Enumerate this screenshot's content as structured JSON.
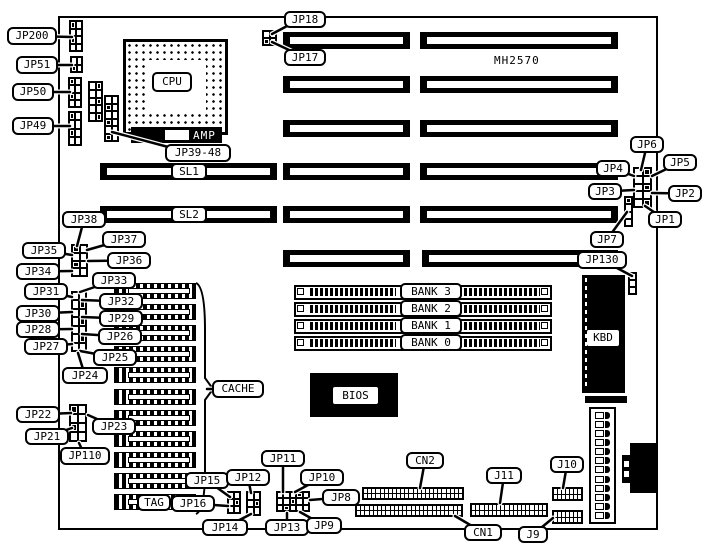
{
  "figure": {
    "bg": "#ffffff",
    "ink": "#000000"
  },
  "static_texts": {
    "model": "MH2570",
    "amp": "AMP"
  },
  "components": {
    "board": {
      "x": 58,
      "y": 16,
      "w": 600,
      "h": 514
    },
    "cpu": {
      "x": 123,
      "y": 39,
      "w": 105,
      "h": 96,
      "inner": {
        "x": 20,
        "y": 18,
        "w": 60,
        "h": 53
      }
    },
    "amp_bar": {
      "x": 131,
      "y": 127,
      "w": 91,
      "h": 16,
      "notch": {
        "x": 34,
        "y": 3,
        "w": 24,
        "h": 10
      }
    },
    "slots": {
      "h": 17,
      "rows": [
        {
          "y": 32,
          "segs": [
            [
              283,
              410
            ],
            [
              420,
              618
            ]
          ]
        },
        {
          "y": 76,
          "segs": [
            [
              283,
              410
            ],
            [
              420,
              618
            ]
          ]
        },
        {
          "y": 120,
          "segs": [
            [
              283,
              410
            ],
            [
              420,
              618
            ]
          ]
        },
        {
          "y": 163,
          "segs": [
            [
              100,
              277
            ],
            [
              283,
              410
            ],
            [
              420,
              618
            ]
          ]
        },
        {
          "y": 206,
          "segs": [
            [
              100,
              277
            ],
            [
              283,
              410
            ],
            [
              420,
              618
            ]
          ]
        },
        {
          "y": 250,
          "segs": [
            [
              283,
              410
            ],
            [
              422,
              618
            ]
          ]
        }
      ]
    },
    "simm": {
      "x": 294,
      "w": 258,
      "h": 15,
      "ys": [
        285,
        302,
        319,
        336
      ]
    },
    "cache_chips": {
      "x": 114,
      "w": 82,
      "h": 16,
      "ys": [
        283,
        304,
        325,
        346,
        367,
        389,
        410,
        431,
        452,
        473,
        494
      ]
    },
    "chips": [
      {
        "id": "bios-chip",
        "x": 310,
        "y": 373,
        "w": 88,
        "h": 44
      },
      {
        "id": "kbd-chip",
        "x": 582,
        "y": 275,
        "w": 43,
        "h": 118
      },
      {
        "id": "fuse-bar",
        "x": 585,
        "y": 396,
        "w": 42,
        "h": 7
      }
    ],
    "jumpers": [
      {
        "id": "jp200-pins",
        "x": 69,
        "y": 20,
        "w": 14,
        "h": 32,
        "cols": 2,
        "rows": 4
      },
      {
        "id": "jp51-pins",
        "x": 70,
        "y": 56,
        "w": 13,
        "h": 17,
        "cols": 2,
        "rows": 2
      },
      {
        "id": "jp50-pins",
        "x": 68,
        "y": 77,
        "w": 14,
        "h": 31,
        "cols": 2,
        "rows": 4
      },
      {
        "id": "jp49-pins",
        "x": 68,
        "y": 111,
        "w": 14,
        "h": 35,
        "cols": 2,
        "rows": 4
      },
      {
        "id": "jp39-48-pins-a",
        "x": 88,
        "y": 81,
        "w": 15,
        "h": 41,
        "cols": 2,
        "rows": 5
      },
      {
        "id": "jp39-48-pins-b",
        "x": 104,
        "y": 95,
        "w": 15,
        "h": 47,
        "cols": 2,
        "rows": 6
      },
      {
        "id": "jp17-18-pins",
        "x": 262,
        "y": 30,
        "w": 15,
        "h": 16,
        "cols": 2,
        "rows": 2
      },
      {
        "id": "jp1-6-pins",
        "x": 633,
        "y": 167,
        "w": 19,
        "h": 41,
        "cols": 2,
        "rows": 5
      },
      {
        "id": "jp7-pins",
        "x": 624,
        "y": 196,
        "w": 9,
        "h": 31,
        "cols": 1,
        "rows": 4
      },
      {
        "id": "jp130-pins",
        "x": 628,
        "y": 272,
        "w": 9,
        "h": 23,
        "cols": 1,
        "rows": 3
      },
      {
        "id": "jp34-38-pins",
        "x": 71,
        "y": 244,
        "w": 17,
        "h": 33,
        "cols": 2,
        "rows": 4
      },
      {
        "id": "jp25-33-pins",
        "x": 71,
        "y": 291,
        "w": 16,
        "h": 61,
        "cols": 2,
        "rows": 7
      },
      {
        "id": "jp21-23-pins",
        "x": 69,
        "y": 404,
        "w": 18,
        "h": 38,
        "cols": 2,
        "rows": 4
      },
      {
        "id": "jp15-16-pins",
        "x": 227,
        "y": 491,
        "w": 14,
        "h": 23,
        "cols": 2,
        "rows": 3
      },
      {
        "id": "jp12-14-pins",
        "x": 246,
        "y": 491,
        "w": 15,
        "h": 25,
        "cols": 2,
        "rows": 3
      },
      {
        "id": "jp8-11-pins",
        "x": 276,
        "y": 491,
        "w": 34,
        "h": 21,
        "cols": 5,
        "rows": 3
      }
    ],
    "headers": [
      {
        "id": "cn2-header-a",
        "x": 362,
        "y": 487,
        "w": 102,
        "h": 13,
        "cols": 24
      },
      {
        "id": "cn2-header-b",
        "x": 355,
        "y": 504,
        "w": 108,
        "h": 13,
        "cols": 25
      },
      {
        "id": "j11-header",
        "x": 470,
        "y": 503,
        "w": 78,
        "h": 14,
        "cols": 18
      },
      {
        "id": "j10-header",
        "x": 552,
        "y": 487,
        "w": 31,
        "h": 14,
        "cols": 7
      },
      {
        "id": "j9-header",
        "x": 552,
        "y": 510,
        "w": 31,
        "h": 14,
        "cols": 7
      }
    ],
    "power": {
      "x": 589,
      "y": 407,
      "w": 27,
      "h": 117,
      "rows": 12
    },
    "din": {
      "rects": [
        {
          "x": 630,
          "y": 443,
          "w": 28,
          "h": 50
        },
        {
          "x": 622,
          "y": 455,
          "w": 12,
          "h": 28
        }
      ],
      "notches": [
        {
          "x": 624,
          "y": 461,
          "w": 5,
          "h": 6
        },
        {
          "x": 624,
          "y": 471,
          "w": 5,
          "h": 6
        }
      ]
    },
    "brace": "M196,283 Q205,287 205,330 L205,378 L213,389 L205,400 L205,470 Q205,510 196,514"
  },
  "part_labels": [
    {
      "id": "cpu",
      "label": "CPU",
      "x": 152,
      "y": 72,
      "w": 40,
      "h": 20
    },
    {
      "id": "sl1",
      "label": "SL1",
      "x": 171,
      "y": 163,
      "w": 36,
      "h": 17
    },
    {
      "id": "sl2",
      "label": "SL2",
      "x": 171,
      "y": 206,
      "w": 36,
      "h": 17
    },
    {
      "id": "bank3",
      "label": "BANK 3",
      "x": 400,
      "y": 283,
      "w": 62,
      "h": 17
    },
    {
      "id": "bank2",
      "label": "BANK 2",
      "x": 400,
      "y": 300,
      "w": 62,
      "h": 17
    },
    {
      "id": "bank1",
      "label": "BANK 1",
      "x": 400,
      "y": 317,
      "w": 62,
      "h": 17
    },
    {
      "id": "bank0",
      "label": "BANK 0",
      "x": 400,
      "y": 334,
      "w": 62,
      "h": 17
    }
  ],
  "inverse_labels": [
    {
      "id": "bios",
      "label": "BIOS",
      "x": 333,
      "y": 387,
      "w": 45,
      "h": 17
    },
    {
      "id": "kbd",
      "label": "KBD",
      "x": 587,
      "y": 330,
      "w": 32,
      "h": 16
    }
  ],
  "callouts": [
    {
      "id": "jp200",
      "label": "JP200",
      "x": 7,
      "y": 27,
      "w": 50,
      "h": 18,
      "tx": 72,
      "ty": 37
    },
    {
      "id": "jp51",
      "label": "JP51",
      "x": 16,
      "y": 56,
      "w": 42,
      "h": 18,
      "tx": 72,
      "ty": 65
    },
    {
      "id": "jp50",
      "label": "JP50",
      "x": 12,
      "y": 83,
      "w": 42,
      "h": 18,
      "tx": 70,
      "ty": 92
    },
    {
      "id": "jp49",
      "label": "JP49",
      "x": 12,
      "y": 117,
      "w": 42,
      "h": 18,
      "tx": 70,
      "ty": 126
    },
    {
      "id": "jp18",
      "label": "JP18",
      "x": 284,
      "y": 11,
      "w": 42,
      "h": 17,
      "tx": 272,
      "ty": 34,
      "sx": 289,
      "sy": 25
    },
    {
      "id": "jp17",
      "label": "JP17",
      "x": 284,
      "y": 49,
      "w": 42,
      "h": 17,
      "tx": 272,
      "ty": 42
    },
    {
      "id": "jp39-48",
      "label": "JP39-48",
      "x": 165,
      "y": 144,
      "w": 66,
      "h": 18,
      "tx": 112,
      "ty": 132,
      "sx": 172,
      "sy": 148
    },
    {
      "id": "jp6",
      "label": "JP6",
      "x": 630,
      "y": 136,
      "w": 34,
      "h": 17,
      "tx": 641,
      "ty": 170
    },
    {
      "id": "jp5",
      "label": "JP5",
      "x": 663,
      "y": 154,
      "w": 34,
      "h": 17,
      "tx": 652,
      "ty": 176
    },
    {
      "id": "jp4",
      "label": "JP4",
      "x": 596,
      "y": 160,
      "w": 34,
      "h": 17,
      "tx": 634,
      "ty": 176
    },
    {
      "id": "jp3",
      "label": "JP3",
      "x": 588,
      "y": 183,
      "w": 34,
      "h": 17,
      "tx": 634,
      "ty": 190
    },
    {
      "id": "jp2",
      "label": "JP2",
      "x": 668,
      "y": 185,
      "w": 34,
      "h": 17,
      "tx": 652,
      "ty": 193
    },
    {
      "id": "jp1",
      "label": "JP1",
      "x": 648,
      "y": 211,
      "w": 34,
      "h": 17,
      "tx": 645,
      "ty": 206
    },
    {
      "id": "jp7",
      "label": "JP7",
      "x": 590,
      "y": 231,
      "w": 34,
      "h": 17,
      "tx": 627,
      "ty": 212
    },
    {
      "id": "jp130",
      "label": "JP130",
      "x": 577,
      "y": 251,
      "w": 50,
      "h": 18,
      "tx": 632,
      "ty": 276
    },
    {
      "id": "jp38",
      "label": "JP38",
      "x": 62,
      "y": 211,
      "w": 44,
      "h": 17,
      "tx": 77,
      "ty": 246
    },
    {
      "id": "jp37",
      "label": "JP37",
      "x": 102,
      "y": 231,
      "w": 44,
      "h": 17,
      "tx": 87,
      "ty": 250
    },
    {
      "id": "jp35",
      "label": "JP35",
      "x": 22,
      "y": 242,
      "w": 44,
      "h": 17,
      "tx": 72,
      "ty": 255
    },
    {
      "id": "jp36",
      "label": "JP36",
      "x": 107,
      "y": 252,
      "w": 44,
      "h": 17,
      "tx": 88,
      "ty": 261
    },
    {
      "id": "jp34",
      "label": "JP34",
      "x": 16,
      "y": 263,
      "w": 44,
      "h": 17,
      "tx": 72,
      "ty": 271
    },
    {
      "id": "jp33",
      "label": "JP33",
      "x": 92,
      "y": 272,
      "w": 44,
      "h": 17,
      "tx": 80,
      "ty": 292
    },
    {
      "id": "jp31",
      "label": "JP31",
      "x": 24,
      "y": 283,
      "w": 44,
      "h": 17,
      "tx": 72,
      "ty": 297
    },
    {
      "id": "jp32",
      "label": "JP32",
      "x": 99,
      "y": 293,
      "w": 44,
      "h": 17,
      "tx": 82,
      "ty": 300
    },
    {
      "id": "jp30",
      "label": "JP30",
      "x": 16,
      "y": 305,
      "w": 44,
      "h": 17,
      "tx": 72,
      "ty": 312
    },
    {
      "id": "jp29",
      "label": "JP29",
      "x": 99,
      "y": 310,
      "w": 44,
      "h": 17,
      "tx": 82,
      "ty": 317
    },
    {
      "id": "jp28",
      "label": "JP28",
      "x": 16,
      "y": 321,
      "w": 44,
      "h": 17,
      "tx": 72,
      "ty": 329
    },
    {
      "id": "jp26",
      "label": "JP26",
      "x": 98,
      "y": 328,
      "w": 44,
      "h": 17,
      "tx": 82,
      "ty": 334
    },
    {
      "id": "jp27",
      "label": "JP27",
      "x": 24,
      "y": 338,
      "w": 44,
      "h": 17,
      "tx": 72,
      "ty": 344
    },
    {
      "id": "jp25",
      "label": "JP25",
      "x": 93,
      "y": 349,
      "w": 44,
      "h": 17,
      "tx": 80,
      "ty": 351
    },
    {
      "id": "jp24",
      "label": "JP24",
      "x": 62,
      "y": 367,
      "w": 46,
      "h": 17,
      "tx": 78,
      "ty": 353
    },
    {
      "id": "jp22",
      "label": "JP22",
      "x": 16,
      "y": 406,
      "w": 44,
      "h": 17,
      "tx": 71,
      "ty": 413
    },
    {
      "id": "jp23",
      "label": "JP23",
      "x": 92,
      "y": 418,
      "w": 44,
      "h": 17,
      "tx": 88,
      "ty": 415
    },
    {
      "id": "jp21",
      "label": "JP21",
      "x": 25,
      "y": 428,
      "w": 44,
      "h": 17,
      "tx": 72,
      "ty": 428
    },
    {
      "id": "jp110",
      "label": "JP110",
      "x": 60,
      "y": 447,
      "w": 50,
      "h": 18,
      "tx": 79,
      "ty": 443
    },
    {
      "id": "tag",
      "label": "TAG",
      "x": 137,
      "y": 494,
      "w": 34,
      "h": 17
    },
    {
      "id": "jp16",
      "label": "JP16",
      "x": 171,
      "y": 495,
      "w": 44,
      "h": 17,
      "tx": 228,
      "ty": 506
    },
    {
      "id": "jp15",
      "label": "JP15",
      "x": 185,
      "y": 472,
      "w": 44,
      "h": 17,
      "tx": 230,
      "ty": 497
    },
    {
      "id": "jp12",
      "label": "JP12",
      "x": 226,
      "y": 469,
      "w": 44,
      "h": 17,
      "tx": 251,
      "ty": 493
    },
    {
      "id": "jp14",
      "label": "JP14",
      "x": 202,
      "y": 519,
      "w": 46,
      "h": 17,
      "tx": 251,
      "ty": 514
    },
    {
      "id": "jp11",
      "label": "JP11",
      "x": 261,
      "y": 450,
      "w": 44,
      "h": 17,
      "tx": 283,
      "ty": 492
    },
    {
      "id": "jp10",
      "label": "JP10",
      "x": 300,
      "y": 469,
      "w": 44,
      "h": 17,
      "tx": 295,
      "ty": 492
    },
    {
      "id": "jp8",
      "label": "JP8",
      "x": 322,
      "y": 489,
      "w": 38,
      "h": 17,
      "tx": 310,
      "ty": 500
    },
    {
      "id": "jp13",
      "label": "JP13",
      "x": 265,
      "y": 519,
      "w": 44,
      "h": 17,
      "tx": 287,
      "ty": 513
    },
    {
      "id": "jp9",
      "label": "JP9",
      "x": 306,
      "y": 517,
      "w": 36,
      "h": 17,
      "tx": 300,
      "ty": 512
    },
    {
      "id": "cn2",
      "label": "CN2",
      "x": 406,
      "y": 452,
      "w": 38,
      "h": 17,
      "tx": 420,
      "ty": 488
    },
    {
      "id": "j11",
      "label": "J11",
      "x": 486,
      "y": 467,
      "w": 36,
      "h": 17,
      "tx": 500,
      "ty": 503
    },
    {
      "id": "j10",
      "label": "J10",
      "x": 550,
      "y": 456,
      "w": 34,
      "h": 17,
      "tx": 563,
      "ty": 488
    },
    {
      "id": "cn1",
      "label": "CN1",
      "x": 464,
      "y": 524,
      "w": 38,
      "h": 17,
      "tx": 455,
      "ty": 516
    },
    {
      "id": "j9",
      "label": "J9",
      "x": 518,
      "y": 526,
      "w": 30,
      "h": 17,
      "tx": 553,
      "ty": 518
    },
    {
      "id": "cache",
      "label": "CACHE",
      "x": 212,
      "y": 380,
      "w": 52,
      "h": 18,
      "tx": 207,
      "ty": 389
    }
  ]
}
